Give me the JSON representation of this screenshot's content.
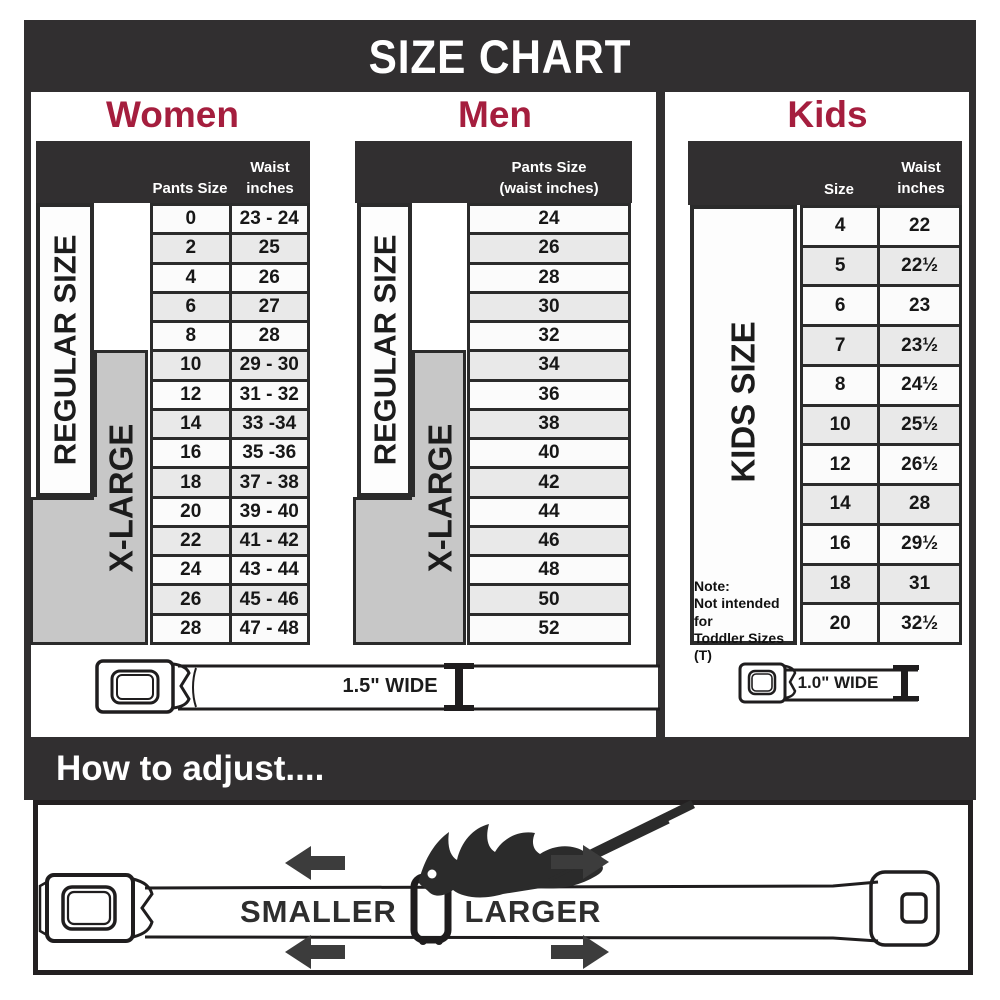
{
  "banner": {
    "title": "SIZE CHART"
  },
  "women": {
    "heading": "Women",
    "col1": "Pants Size",
    "col2_line1": "Waist",
    "col2_line2": "inches",
    "regular": "REGULAR SIZE",
    "xlarge": "X-LARGE"
  },
  "men": {
    "heading": "Men",
    "col_line1": "Pants Size",
    "col_line2": "(waist inches)",
    "regular": "REGULAR SIZE",
    "xlarge": "X-LARGE"
  },
  "kids": {
    "heading": "Kids",
    "col1": "Size",
    "col2_line1": "Waist",
    "col2_line2": "inches",
    "side": "KIDS SIZE",
    "note1": "Note:",
    "note2": "Not intended for",
    "note3": "Toddler Sizes (T)"
  },
  "belts": {
    "adult_label": "1.5\" WIDE",
    "kids_label": "1.0\" WIDE"
  },
  "how_to_adjust": {
    "heading": "How to adjust....",
    "smaller": "SMALLER",
    "larger": "LARGER"
  },
  "colors": {
    "dark_banner": "#312f30",
    "accent_red": "#a51e3e",
    "row_light": "#fbfbfb",
    "row_alt": "#e9e9e9",
    "xlarge_gray": "#c7c7c7",
    "grid_line": "#2b2b2b"
  },
  "chart_data": [
    {
      "type": "table",
      "title": "Women",
      "columns": [
        "Pants Size",
        "Waist inches"
      ],
      "group_labels": [
        "REGULAR SIZE",
        "X-LARGE"
      ],
      "rows": [
        [
          "0",
          "23 - 24"
        ],
        [
          "2",
          "25"
        ],
        [
          "4",
          "26"
        ],
        [
          "6",
          "27"
        ],
        [
          "8",
          "28"
        ],
        [
          "10",
          "29 - 30"
        ],
        [
          "12",
          "31 - 32"
        ],
        [
          "14",
          "33 -34"
        ],
        [
          "16",
          "35 -36"
        ],
        [
          "18",
          "37 - 38"
        ],
        [
          "20",
          "39 - 40"
        ],
        [
          "22",
          "41 - 42"
        ],
        [
          "24",
          "43 - 44"
        ],
        [
          "26",
          "45 - 46"
        ],
        [
          "28",
          "47 - 48"
        ]
      ]
    },
    {
      "type": "table",
      "title": "Men",
      "columns": [
        "Pants Size (waist inches)"
      ],
      "group_labels": [
        "REGULAR SIZE",
        "X-LARGE"
      ],
      "rows": [
        [
          "24"
        ],
        [
          "26"
        ],
        [
          "28"
        ],
        [
          "30"
        ],
        [
          "32"
        ],
        [
          "34"
        ],
        [
          "36"
        ],
        [
          "38"
        ],
        [
          "40"
        ],
        [
          "42"
        ],
        [
          "44"
        ],
        [
          "46"
        ],
        [
          "48"
        ],
        [
          "50"
        ],
        [
          "52"
        ]
      ]
    },
    {
      "type": "table",
      "title": "Kids",
      "columns": [
        "Size",
        "Waist inches"
      ],
      "group_labels": [
        "KIDS SIZE"
      ],
      "note": [
        "Note:",
        "Not intended for",
        "Toddler Sizes (T)"
      ],
      "rows": [
        [
          "4",
          "22"
        ],
        [
          "5",
          "22½"
        ],
        [
          "6",
          "23"
        ],
        [
          "7",
          "23½"
        ],
        [
          "8",
          "24½"
        ],
        [
          "10",
          "25½"
        ],
        [
          "12",
          "26½"
        ],
        [
          "14",
          "28"
        ],
        [
          "16",
          "29½"
        ],
        [
          "18",
          "31"
        ],
        [
          "20",
          "32½"
        ]
      ]
    }
  ]
}
